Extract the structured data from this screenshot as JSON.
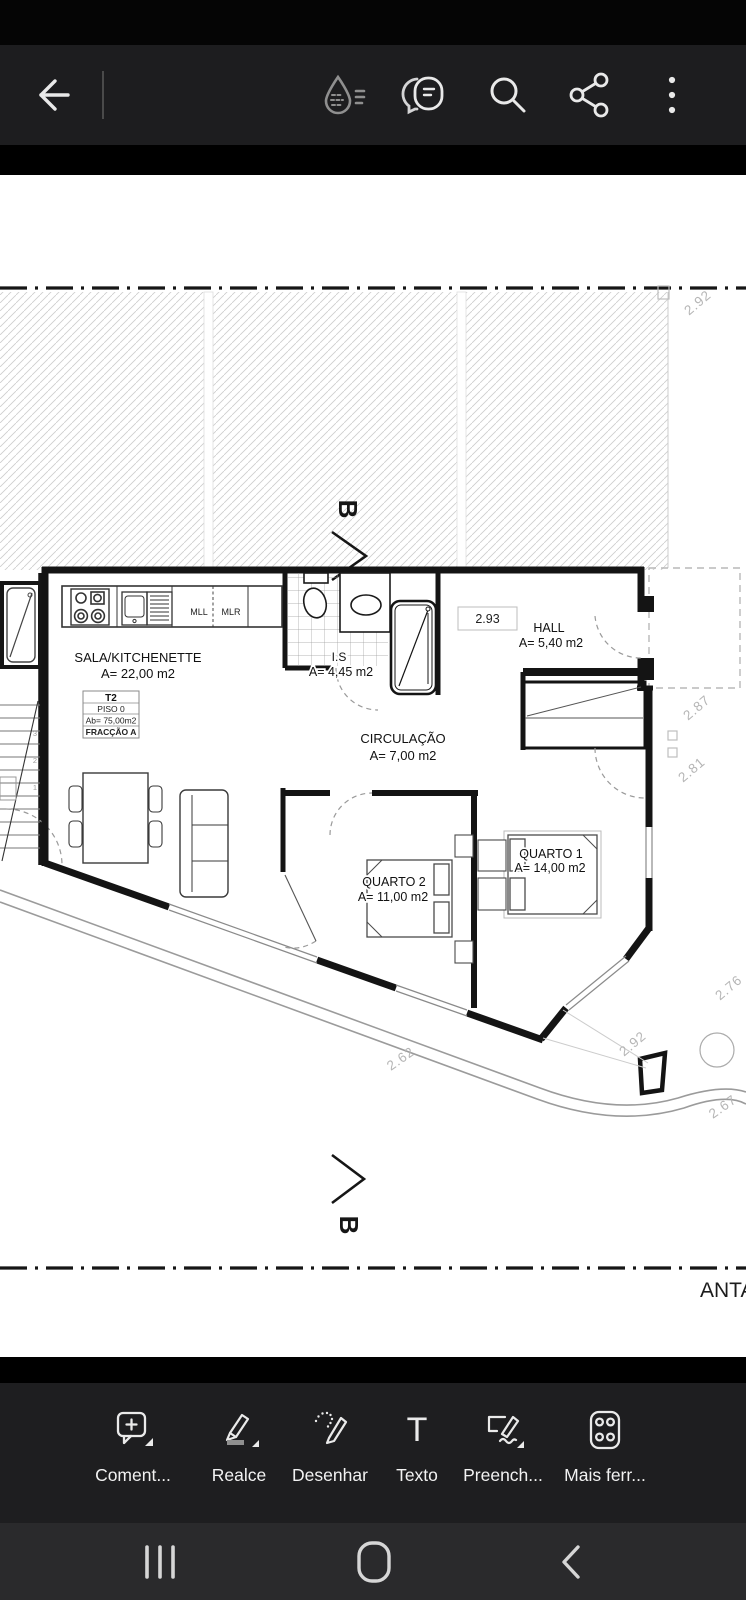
{
  "app": {
    "name_hint": "pdf-viewer"
  },
  "top_toolbar": {
    "icons": [
      "back-arrow",
      "liquid-mode",
      "view-comments",
      "search",
      "share",
      "overflow-menu"
    ]
  },
  "document": {
    "plan": {
      "rooms": {
        "sala": {
          "name": "SALA/KITCHENETTE",
          "area": "A= 22,00 m2"
        },
        "is": {
          "name": "I.S",
          "area": "A= 4,45 m2"
        },
        "hall": {
          "name": "HALL",
          "area": "A= 5,40 m2"
        },
        "circulacao": {
          "name": "CIRCULAÇÃO",
          "area": "A= 7,00 m2"
        },
        "quarto1": {
          "name": "QUARTO 1",
          "area": "A= 14,00 m2"
        },
        "quarto2": {
          "name": "QUARTO 2",
          "area": "A= 11,00 m2"
        }
      },
      "unit": {
        "type": "T2",
        "floor": "PISO 0",
        "gross_area": "Ab= 75,00m2",
        "fraction": "FRACÇÃO A"
      },
      "appliances": {
        "mll": "MLL",
        "mlr": "MLR"
      },
      "dims": {
        "hall_width": "2.93",
        "top_right": "2.92",
        "right_upper": "2.87",
        "right_lower": "2.81",
        "bottom_right_outer": "2.76",
        "bottom_right": "2.92",
        "bottom_left": "2.62",
        "corner": "2.67"
      },
      "section": {
        "label": "B"
      },
      "stair_numbers": [
        "1",
        "2",
        "3"
      ],
      "partial_label": "ANTA"
    }
  },
  "fab": {
    "icon": "ai-comment-sparkle",
    "color_start": "#cd2a62",
    "color_end": "#6b3bd9"
  },
  "bottom_toolbar": {
    "tools": [
      {
        "label": "Coment..."
      },
      {
        "label": "Realce"
      },
      {
        "label": "Desenhar"
      },
      {
        "label": "Texto"
      },
      {
        "label": "Preench..."
      },
      {
        "label": "Mais ferr..."
      }
    ]
  },
  "nav_bar": {
    "icons": [
      "recents",
      "home",
      "back"
    ]
  }
}
